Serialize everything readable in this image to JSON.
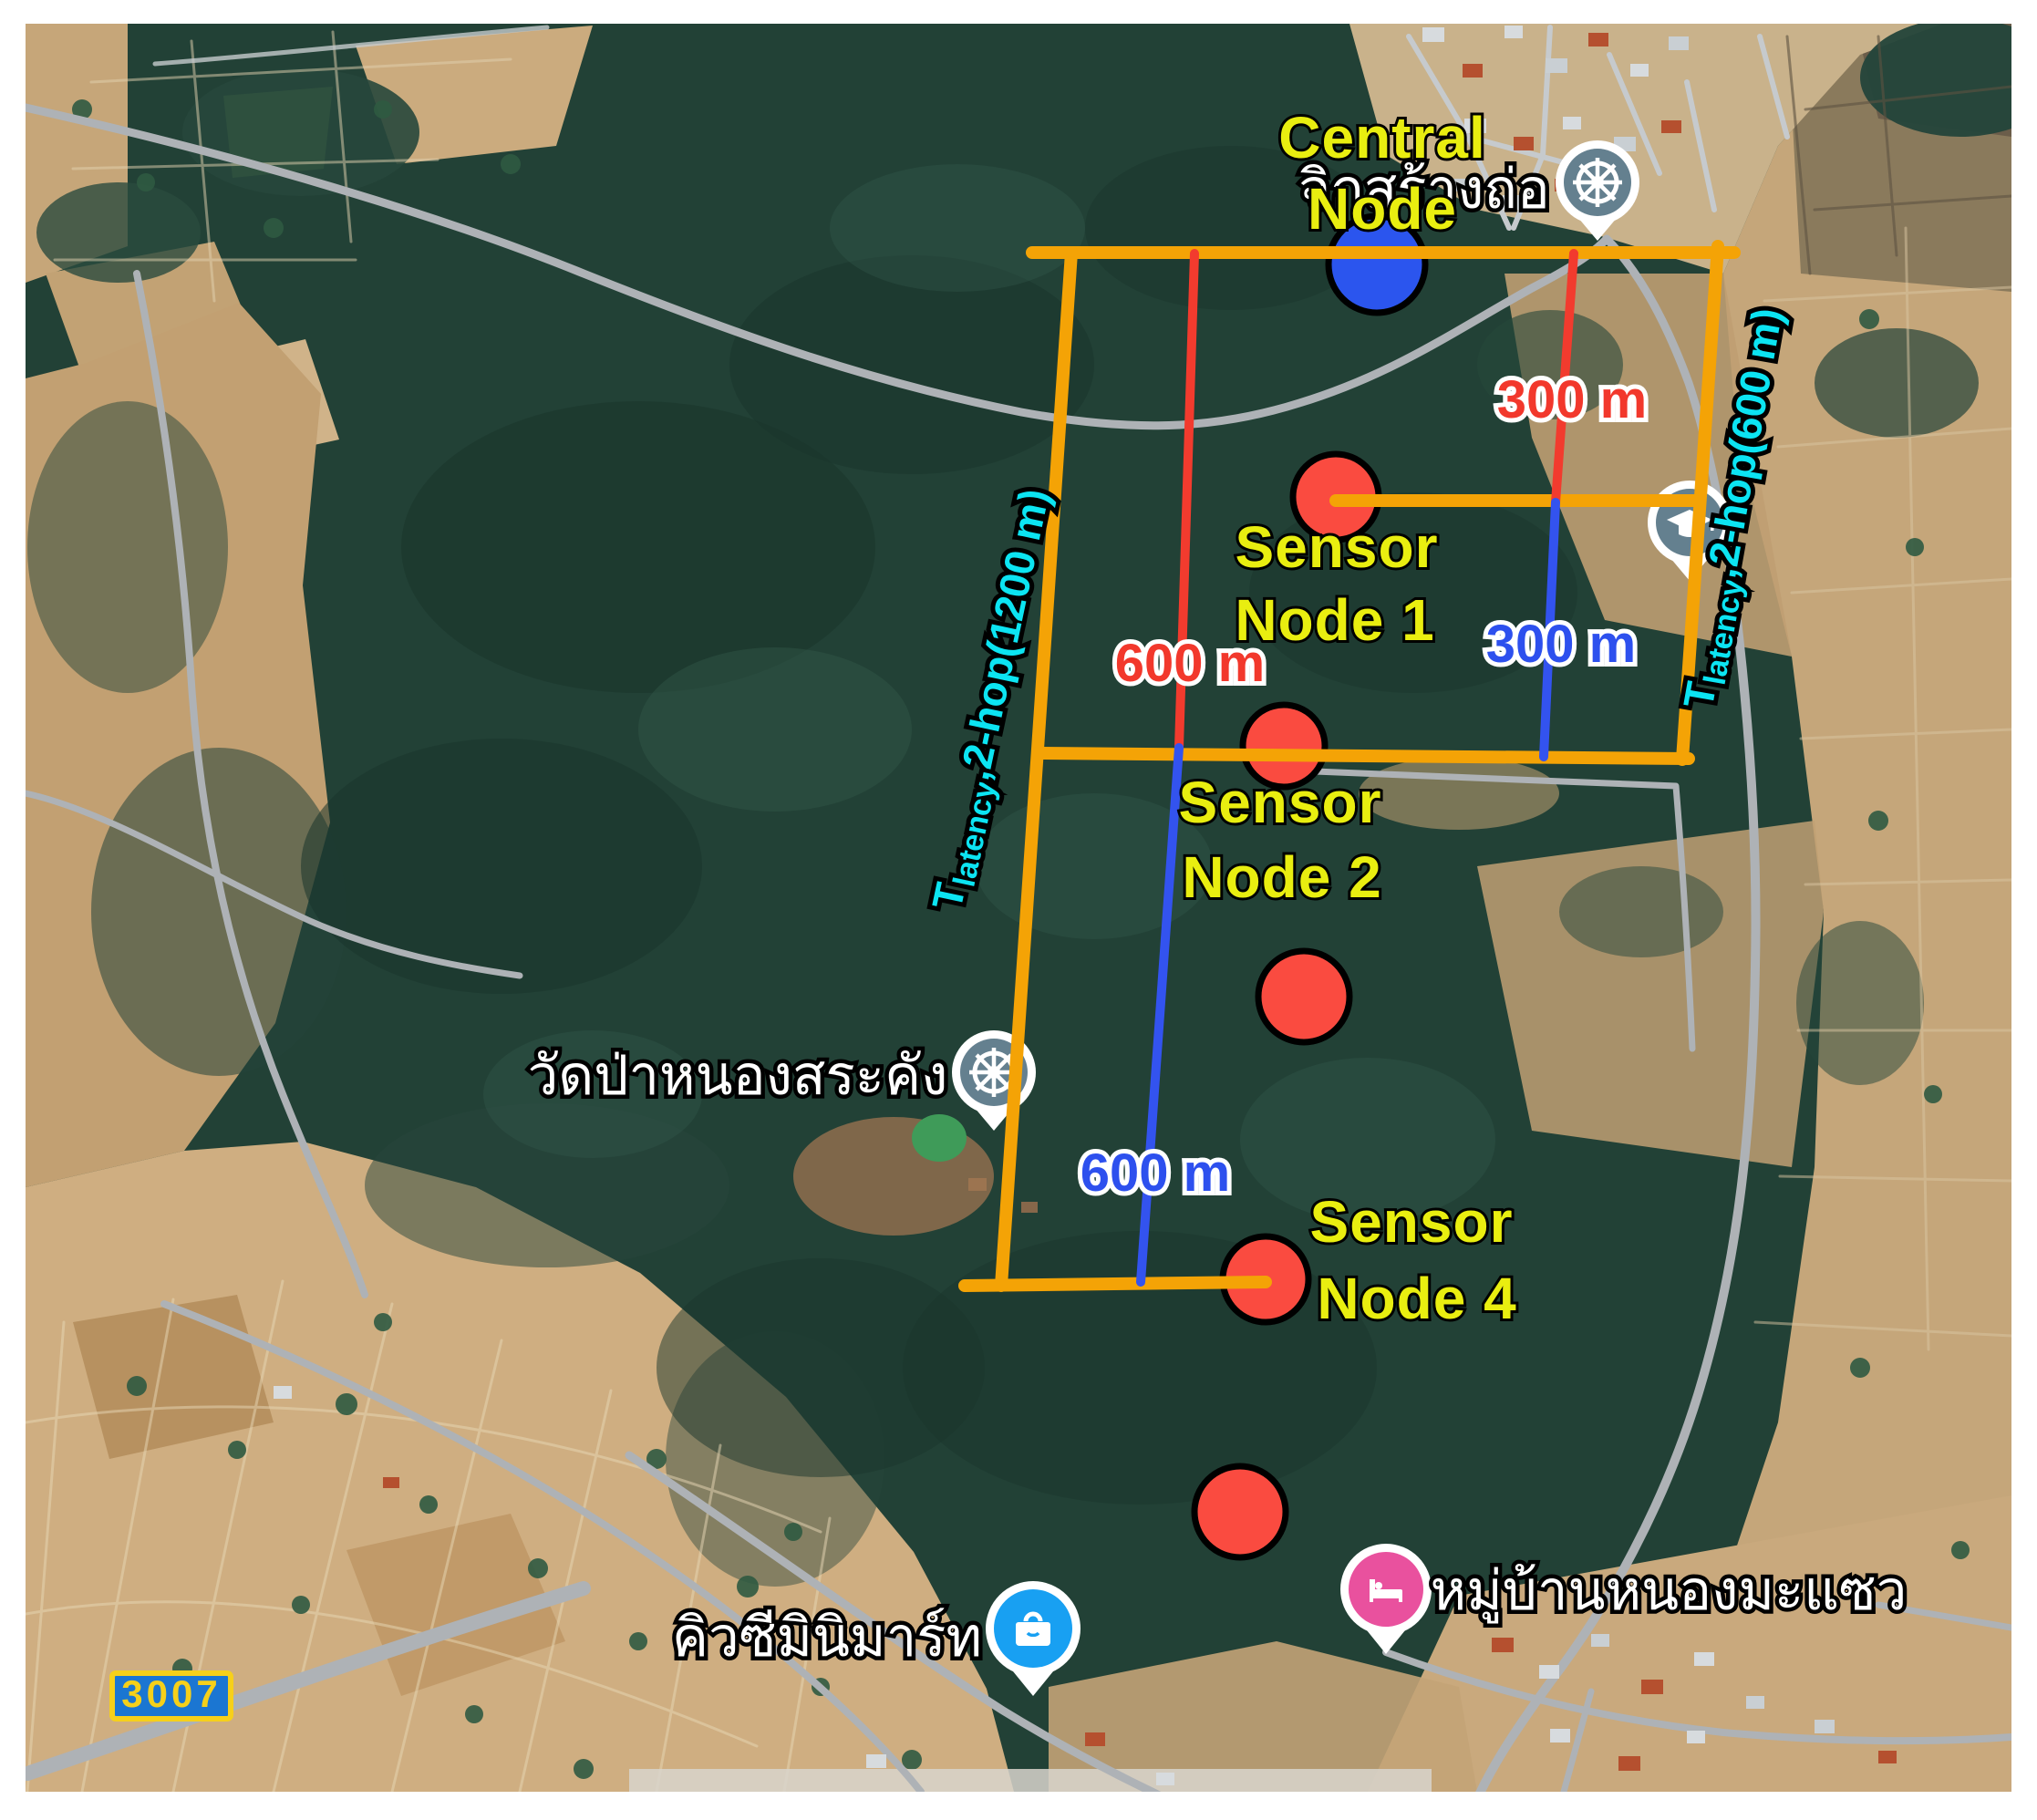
{
  "figure": {
    "description": "Satellite map figure showing a wireless sensor network deployment over a forest area",
    "map_type": "satellite"
  },
  "colors": {
    "topology_line_orange": "#F4A306",
    "distance_line_red": "#F23B2E",
    "distance_line_blue": "#3353EF",
    "sensor_node_fill": "#FA4B40",
    "central_node_fill": "#2B55EE",
    "node_outline": "#000000",
    "label_yellow": "#E9EE10",
    "label_cyan": "#0CE4F2",
    "label_white": "#FFFFFF",
    "distance_label_red": "#F2382C",
    "distance_label_blue": "#2D50EE",
    "road_badge_fill": "#1B76D2",
    "road_badge_yellow": "#F6D01A",
    "poi_pin_gray": "#64808F",
    "poi_pin_pink": "#E9519E",
    "poi_pin_blue": "#18A0F2"
  },
  "central_node": {
    "line1": "Central",
    "line2": "Node"
  },
  "sensor_labels": {
    "node1": {
      "line1": "Sensor",
      "line2": "Node 1"
    },
    "node2": {
      "line1": "Sensor",
      "line2": "Node 2"
    },
    "node4": {
      "line1": "Sensor",
      "line2": "Node 4"
    }
  },
  "distances": {
    "red_300": "300 m",
    "blue_300": "300 m",
    "red_600": "600 m",
    "blue_600": "600 m"
  },
  "latency": {
    "left": {
      "prefix": "T",
      "sub": "latency",
      "rest": ",2-hop(1200 m)"
    },
    "right": {
      "prefix": "T",
      "sub": "latency",
      "rest": ",2-hop(600 m)"
    }
  },
  "map_labels": {
    "village_top": "จิกสร้างถ่อ",
    "temple": "วัดป่าหนองสระคัง",
    "minimart": "คิวซีมินิมาร์ท",
    "village_bottom": "หมู่บ้านหนองมะแซว"
  },
  "road_badge": {
    "number": "3007"
  },
  "icons": {
    "pin_village_top": "dharma-wheel-icon",
    "pin_school": "school-icon",
    "pin_temple": "dharma-wheel-icon",
    "pin_minimart": "shopping-bag-icon",
    "pin_village_bottom": "bed-icon"
  }
}
